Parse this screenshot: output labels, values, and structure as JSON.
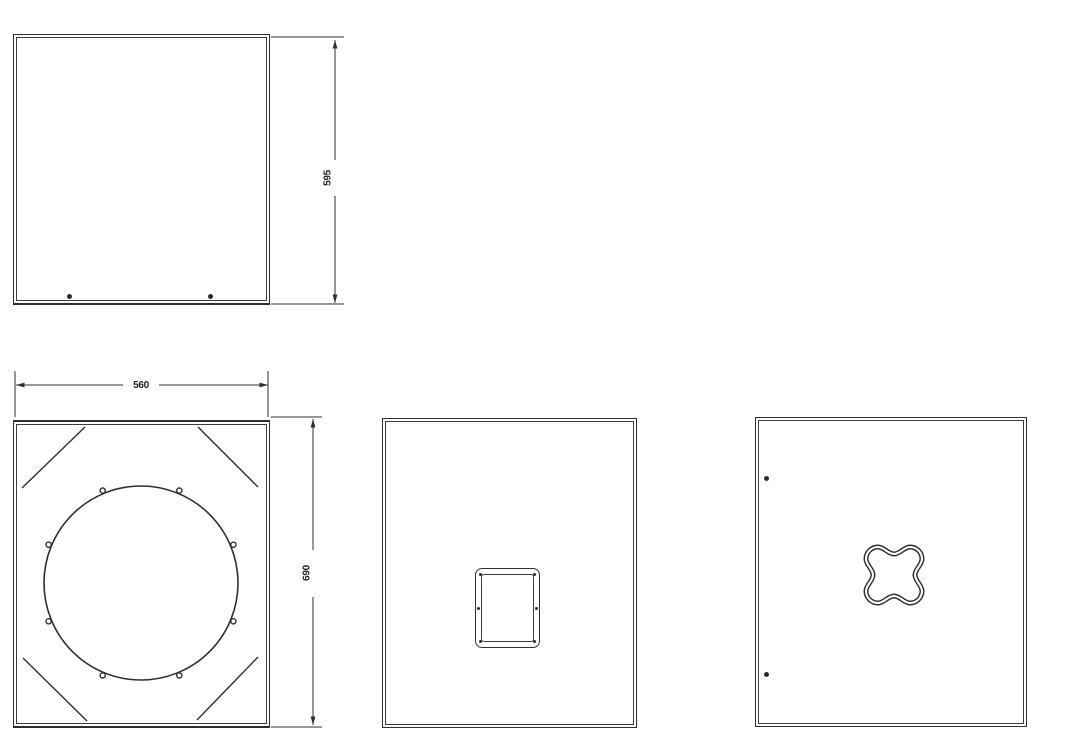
{
  "drawing": {
    "background_color": "#ffffff",
    "line_color": "#2f2f2f",
    "dimensions": {
      "depth_mm": "595",
      "width_mm": "560",
      "height_mm": "690"
    },
    "views": {
      "top_left": "side-panel-with-feet",
      "bottom_left": "front-baffle-with-speaker-cutout",
      "bottom_middle": "rear-panel-with-connector-plate",
      "bottom_right": "side-panel-with-handle-cutout"
    }
  }
}
